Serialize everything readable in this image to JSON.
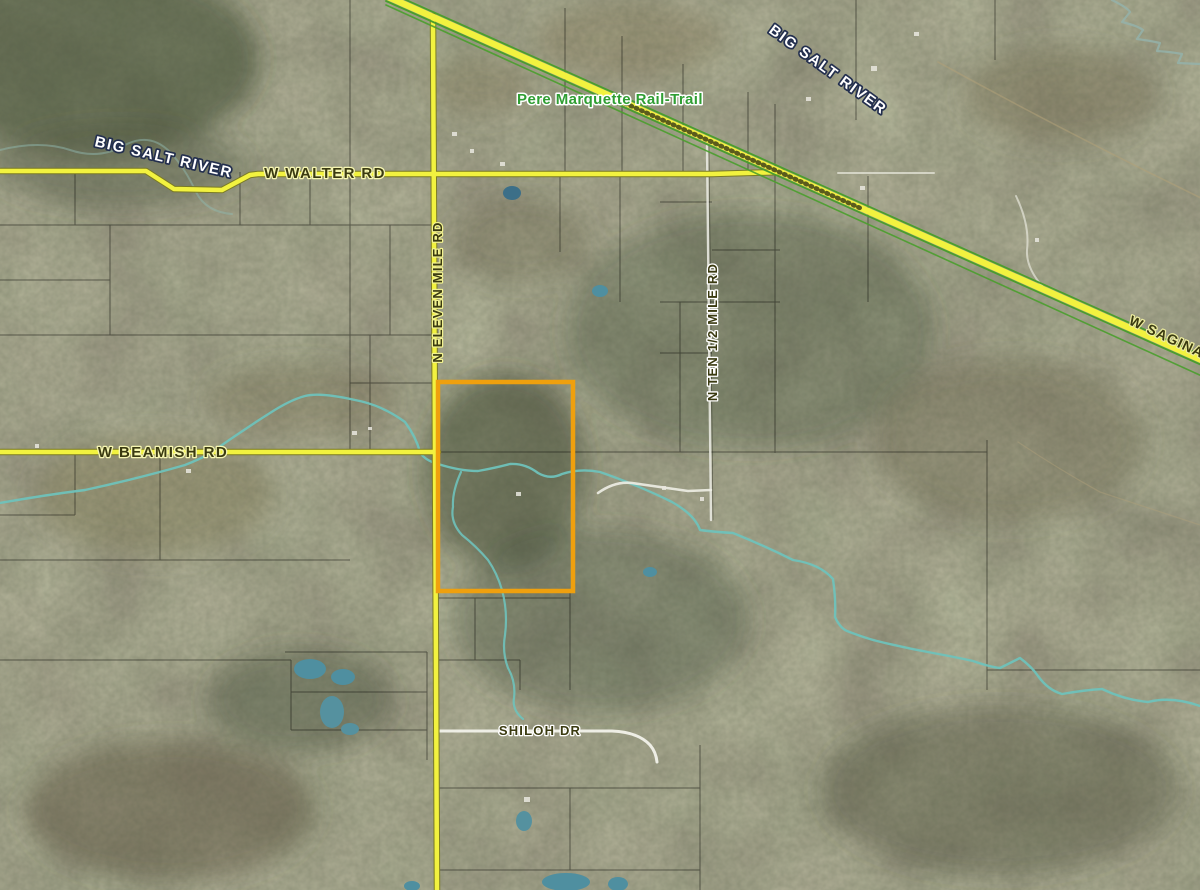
{
  "map": {
    "labels": {
      "river_top_right": "BIG SALT RIVER",
      "river_left": "BIG SALT RIVER",
      "rail_trail": "Pere Marquette Rail-Trail",
      "walter_rd": "W WALTER RD",
      "saginaw_rd": "W SAGINAW",
      "eleven_mile_rd": "N ELEVEN MILE RD",
      "ten_half_mile_rd": "N TEN 1/2 MILE RD",
      "beamish_rd": "W BEAMISH RD",
      "shiloh_dr": "SHILOH DR"
    },
    "colors": {
      "road_yellow": "#f2f23f",
      "road_casing": "#7a7a26",
      "trail_green": "#4a9e2d",
      "water": "#6fc2bb",
      "pond": "#4f8fa0",
      "parcel_highlight": "#efa00e",
      "trail_label_green": "#2f9e33",
      "road_label_dark": "#3a3a10",
      "river_label_fill": "#ffffff",
      "river_label_outline": "#232f4e"
    }
  }
}
